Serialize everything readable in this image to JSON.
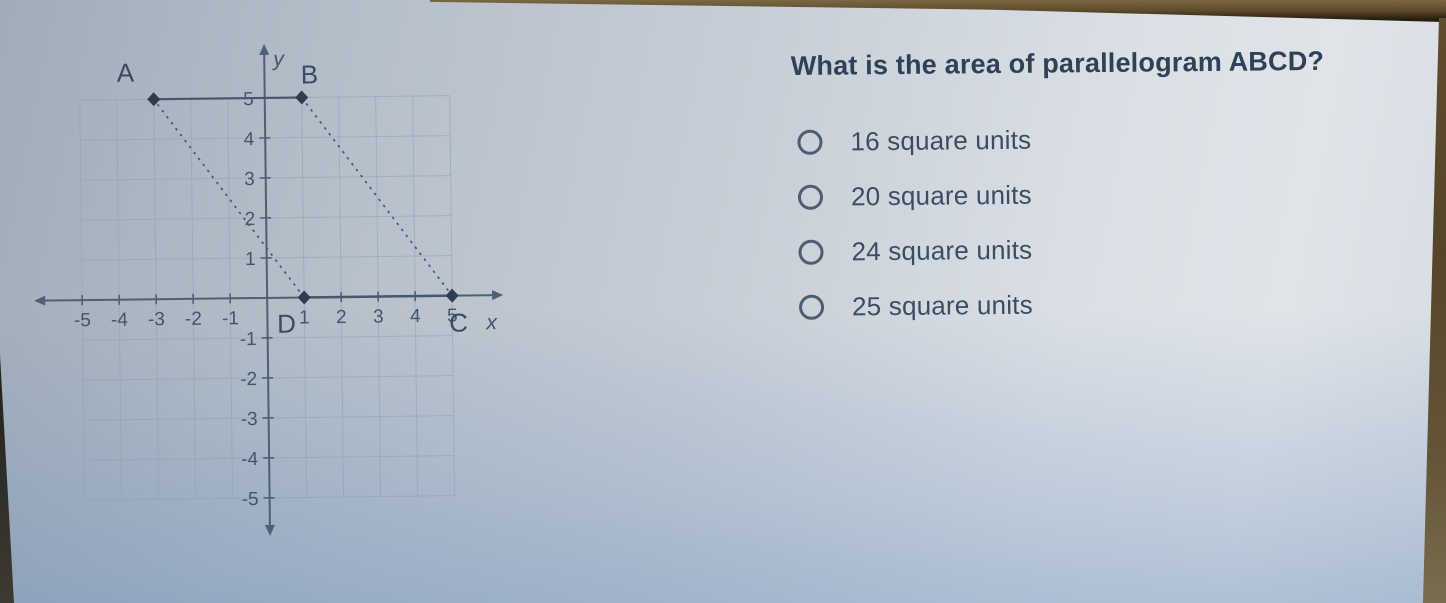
{
  "question": {
    "text": "What is the area of parallelogram ABCD?"
  },
  "options": [
    {
      "label": "16 square units",
      "selected": false
    },
    {
      "label": "20 square units",
      "selected": false
    },
    {
      "label": "24 square units",
      "selected": false
    },
    {
      "label": "25 square units",
      "selected": false
    }
  ],
  "graph": {
    "figure": "parallelogram ABCD on coordinate plane",
    "x_label": "x",
    "y_label": "y",
    "x_ticks": [
      -5,
      -4,
      -3,
      -2,
      -1,
      1,
      2,
      3,
      4,
      5
    ],
    "y_ticks": [
      5,
      4,
      3,
      2,
      1,
      -1,
      -2,
      -3,
      -4,
      -5
    ],
    "points": [
      {
        "name": "A",
        "x": -3,
        "y": 5
      },
      {
        "name": "B",
        "x": 1,
        "y": 5
      },
      {
        "name": "C",
        "x": 5,
        "y": 0
      },
      {
        "name": "D",
        "x": 1,
        "y": 0
      }
    ]
  },
  "colors": {
    "ink": "#41556b",
    "axis": "#4e6076",
    "grid": "#8fa0b2",
    "desk_edge": "#5d4a2b"
  }
}
